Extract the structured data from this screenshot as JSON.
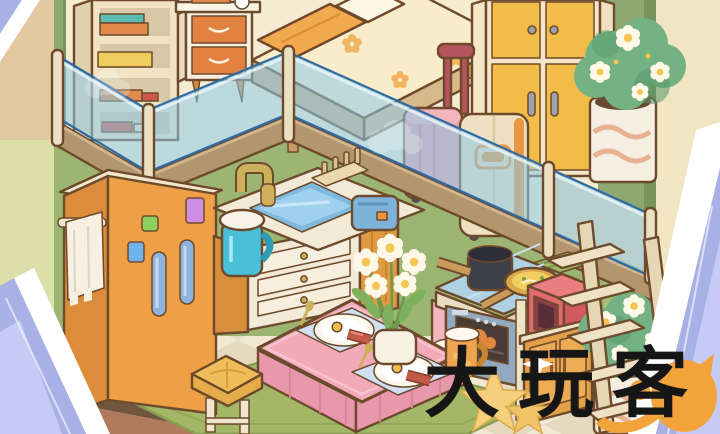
{
  "watermark": {
    "text": "大玩客"
  },
  "scene": {
    "description": "Isometric cartoon loft apartment from a cozy home-decoration game",
    "upper_loft": {
      "items": [
        "bookshelf with colorful books",
        "bedside table with book stack and clock",
        "bed with cream floral mattress and orange blanket",
        "yellow four-door wardrobe",
        "blue glass balcony railing with cream posts",
        "pink suitcase with maroon handle",
        "beige suitcase with orange trim",
        "white flowering plant in wavy-pattern pot"
      ]
    },
    "kitchen": {
      "items": [
        "orange refrigerator with blue handles and magnets",
        "hanging white towel",
        "counter with blue sink and gold faucet",
        "teal water jug with white lid",
        "wooden dish rack",
        "blue toaster",
        "under-sink drawer cabinet",
        "black stockpot on stove",
        "frying pan with egg soup",
        "red microwave",
        "oven with roast chicken",
        "wooden cabinet",
        "green bamboo mat"
      ]
    },
    "dining": {
      "items": [
        "table with pink tablecloth",
        "two blue placemats",
        "breakfast plates with fried egg and sausage",
        "gold cutlery",
        "vase of white daisies",
        "orange mug of milk",
        "yellow stool",
        "green rug"
      ]
    },
    "misc": {
      "items": [
        "wooden ladder to loft",
        "floor flowering plant",
        "two yellow stars",
        "white sparkle",
        "checkered tile floor",
        "orange cat watermark logo",
        "periwinkle crystal frame corners"
      ]
    }
  },
  "colors": {
    "outline": "#6e4a2c",
    "ink": "#161616",
    "periwinkle": "#a8b1e6",
    "periwinkle-light": "#c5cbf4",
    "cream-bg": "#f2e5c2",
    "tan-wall": "#e2c9a2",
    "pale-green": "#dcdfa8",
    "green-wall": "#8fa872",
    "green-wall-dark": "#78935e",
    "green-wall-light": "#a9bd72",
    "kitchen-wall": "#9cb573",
    "loft-cream": "#f6ecd2",
    "loft-floor": "#ecd9b2",
    "floor-tile": "#f1e8d4",
    "floor-tile-dark": "#e5d9bf",
    "baseboard": "#6f563d",
    "terracotta": "#b07a5e",
    "rug-green": "#a3b766",
    "rug-green-dark": "#8a9c52",
    "band-brown": "#b3966d",
    "glass-blue": "#8ecbe8",
    "glass-edge": "#2f6ba3",
    "post-cream": "#ece0c2",
    "shelf-cream": "#f1e3c4",
    "shelf-side": "#e2d1ad",
    "book-teal": "#5cbcb2",
    "book-orange": "#e28a4a",
    "book-yellow": "#f0cc5c",
    "book-red": "#d05848",
    "nightstand": "#f7efdd",
    "drawer-orange": "#e28140",
    "mattress": "#f8eccb",
    "bed-frame": "#d9b98c",
    "blanket": "#f2a94e",
    "flower-orange": "#f0b55e",
    "wardrobe-yellow": "#f2bc49",
    "wardrobe-frame": "#f4e6c6",
    "handle-gray": "#9aa2ac",
    "plant-green": "#74b183",
    "plant-dark": "#569869",
    "flower-white": "#fef8e8",
    "flower-center": "#f4c653",
    "pot-white": "#f5efe1",
    "pot-wave": "#eab092",
    "soil": "#6b4a33",
    "case-pink": "#f0a3ad",
    "case-maroon": "#b5535f",
    "case-cream": "#efe0c2",
    "case-orange": "#e8963f",
    "fridge": "#ef9f45",
    "fridge-side": "#dd8c3c",
    "fridge-handle": "#8fb4dc",
    "magnet-blue": "#6db2e8",
    "magnet-green": "#8ed05e",
    "magnet-purple": "#cf8ee2",
    "towel": "#f6efe2",
    "counter-cream": "#f2ead6",
    "sink-blue": "#7fb9de",
    "water-blue": "#9fd1ef",
    "gold": "#cdb05c",
    "pitcher": "#49c0d8",
    "toaster": "#7fb2d8",
    "wood": "#e09b42",
    "tile-blue": "#aed2e4",
    "station-pink": "#f2b7bd",
    "oven-gray": "#93a9bf",
    "oven-window": "#4a3b35",
    "roast": "#e0873f",
    "pot-black": "#3f3f4a",
    "pan-gold": "#d9a94c",
    "soup": "#f2cf62",
    "micro-red": "#e06a6e",
    "micro-dark": "#8a3f4a",
    "cloth-pink": "#f2aab9",
    "cloth-dark": "#e798ab",
    "mat-blue": "#cfe0f2",
    "plate": "#fbf7ec",
    "yolk": "#f2bd4d",
    "sausage": "#c25a48",
    "mug": "#eda64f",
    "milk": "#fdf8ee",
    "stool-yellow": "#eebc58",
    "ladder": "#e6d6b4",
    "star-yellow": "#f6cf7d",
    "star-deep": "#f2c468",
    "cat-orange": "#f3a33c",
    "white": "#ffffff"
  }
}
